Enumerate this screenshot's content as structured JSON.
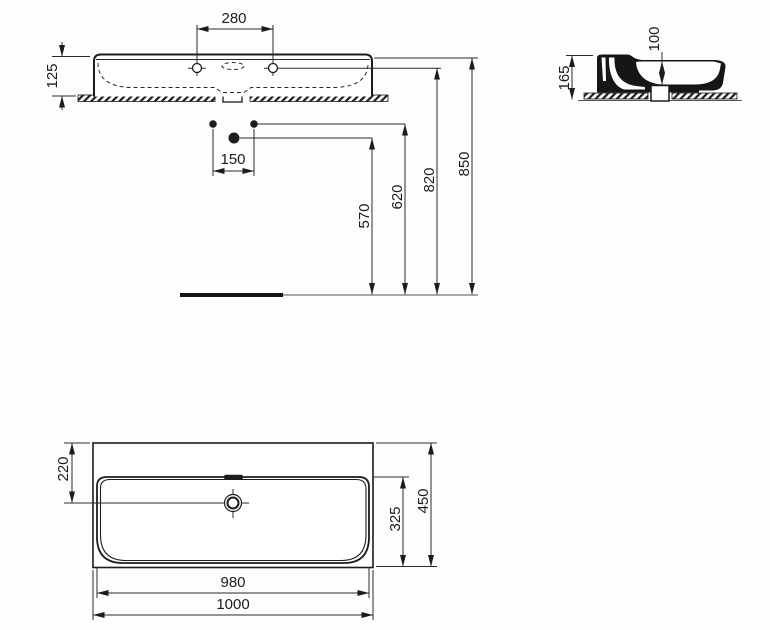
{
  "page": {
    "background": "#fdfdfd",
    "line_color": "#1c1c1c",
    "kind": "washbasin installation dimension drawing"
  },
  "front_view": {
    "name": "front elevation",
    "dims": {
      "tap_hole_spacing": "280",
      "basin_edge_height": "125",
      "supply_spacing": "150",
      "waste_outlet_height": "570",
      "supply_height": "620",
      "tap_centre_height": "820",
      "rim_height": "850"
    }
  },
  "side_view": {
    "name": "side section",
    "dims": {
      "overall_height": "165",
      "bowl_inner_depth": "100"
    }
  },
  "plan_view": {
    "name": "plan view",
    "dims": {
      "drain_centre_from_back": "220",
      "overall_depth": "450",
      "bowl_front_to_back": "325",
      "bowl_width": "980",
      "overall_width": "1000"
    }
  }
}
